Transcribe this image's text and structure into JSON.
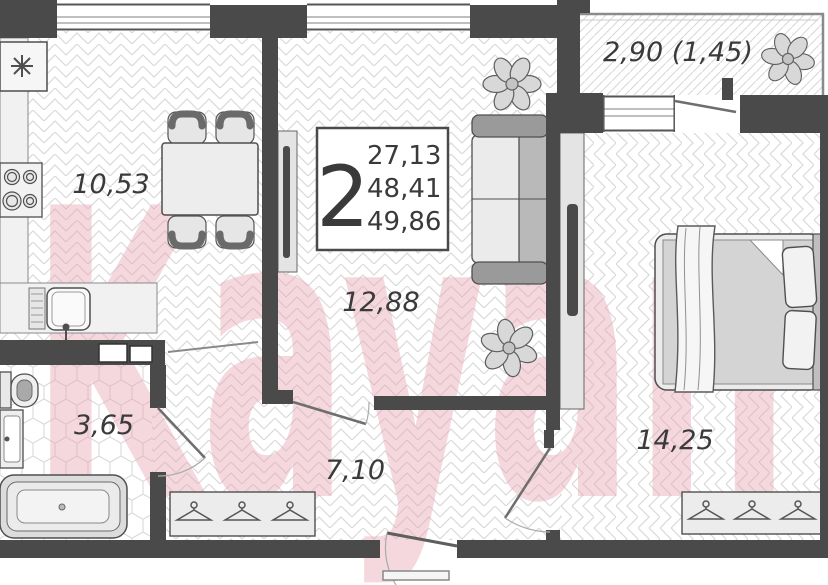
{
  "watermark": "Kayan",
  "info_box": {
    "room_count": "2",
    "area_living": "27,13",
    "area_flat": "48,41",
    "area_total": "49,86"
  },
  "rooms": {
    "kitchen": "10,53",
    "living_room": "12,88",
    "bathroom": "3,65",
    "hallway": "7,10",
    "bedroom": "14,25",
    "balcony": "2,90 (1,45)"
  },
  "colors": {
    "wall": "#4a4a4a",
    "floor_hatch": "#d9d9d9",
    "watermark": "#e9a2b2",
    "label_text": "#3a3a3a"
  }
}
